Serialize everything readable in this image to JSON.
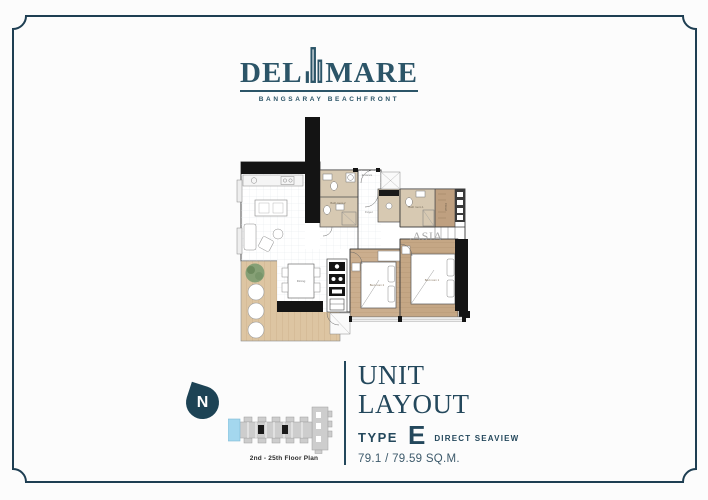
{
  "page": {
    "background": "#fcfcfc",
    "frame_color": "#1e3e52"
  },
  "logo": {
    "name_left": "DEL",
    "name_right": "MARE",
    "tagline": "BANGSARAY BEACHFRONT",
    "color": "#2c5568"
  },
  "floorplan": {
    "watermark": ".ASIA",
    "labels": {
      "entrance": "Entrance",
      "foyer": "Foyer",
      "bath1": "Bath room 1",
      "bath2": "Bath room 2",
      "bed1": "Bed room 1",
      "bed2": "Bed room 2",
      "dining": "Dining",
      "closet": "Closet"
    },
    "colors": {
      "wall": "#141414",
      "bath_floor": "#d7c9b2",
      "bedroom_floor": "#cbae8e",
      "balcony_deck": "#ddc5a2"
    }
  },
  "compass": {
    "north_label": "N"
  },
  "keyplan": {
    "caption": "2nd - 25th Floor Plan",
    "highlight_color": "#a4d7ee"
  },
  "unit_info": {
    "title_line1": "UNIT",
    "title_line2": "LAYOUT",
    "type_label": "TYPE",
    "type_value": "E",
    "view_text": "DIRECT SEAVIEW",
    "area_text": "79.1 / 79.59 SQ.M."
  }
}
